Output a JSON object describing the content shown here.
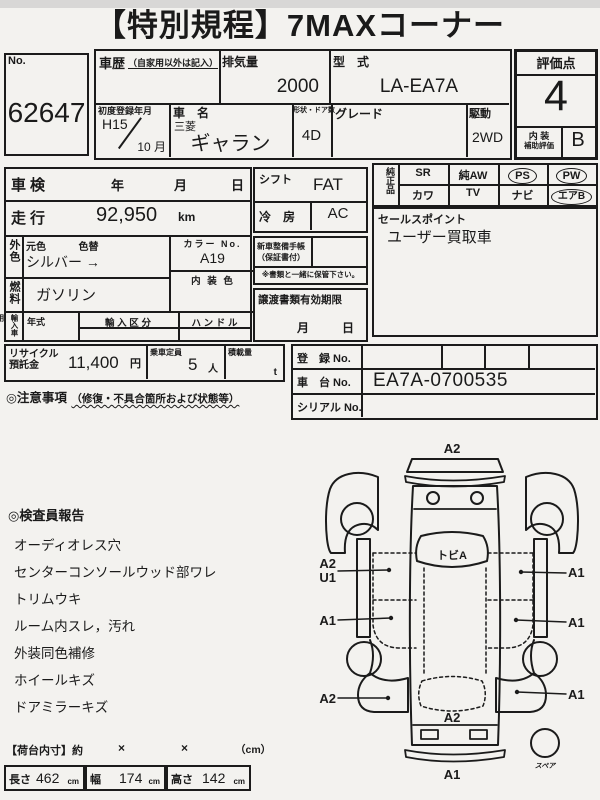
{
  "title": "【特別規程】7MAXコーナー",
  "lot": {
    "label": "No.",
    "value": "62647"
  },
  "header": {
    "history_label": "車歴",
    "history_note": "（自家用以外は記入）",
    "displacement_label": "排気量",
    "displacement_value": "2000",
    "model_code_label": "型　式",
    "model_code_value": "LA-EA7A",
    "first_reg_label": "初度登録年月",
    "first_reg_year": "H15",
    "first_reg_month": "10 月",
    "name_label": "車　名",
    "maker": "三菱",
    "model": "ギャラン",
    "shape_label": "形状・ドア数",
    "shape_value": "4D",
    "grade_label": "グレード",
    "drive_label": "駆動",
    "drive_value": "2WD"
  },
  "rating": {
    "label": "評価点",
    "score": "4",
    "interior_label_1": "内 装",
    "interior_label_2": "補助評価",
    "interior_score": "B"
  },
  "left_panel": {
    "shaken_label": "車検",
    "year": "年",
    "month": "月",
    "day": "日",
    "mileage_label": "走行",
    "mileage_value": "92,950",
    "mileage_unit": "km",
    "ext_color_label": "外色",
    "orig_color_label": "元色",
    "recolor_label": "色替",
    "color_value": "シルバー →",
    "color_no_label": "カラー No.",
    "color_no_value": "A19",
    "fuel_label": "燃料",
    "fuel_value": "ガソリン",
    "interior_color_label": "内 装 色",
    "import_label": "輸入車用",
    "import_year_label": "年式",
    "import_class_label": "輸 入 区 分",
    "handle_label": "ハ ン ド ル",
    "recycle_label_1": "リサイクル",
    "recycle_label_2": "預託金",
    "recycle_value": "11,400",
    "recycle_unit": "円",
    "capacity_label": "乗車定員",
    "capacity_value": "5",
    "capacity_unit": "人",
    "load_label": "積載量",
    "load_unit": "t",
    "notes_label": "◎注意事項",
    "notes_note": "（修復・不具合箇所および状態等）"
  },
  "mid_panel": {
    "shift_label": "シフト",
    "shift_value": "FAT",
    "ac_label": "冷　房",
    "ac_value": "AC",
    "book_label_1": "新車整備手帳",
    "book_label_2": "（保証書付）",
    "keep_note": "※書類と一緒に保管下さい。",
    "transfer_label": "譲渡書類有効期限",
    "transfer_month": "月",
    "transfer_day": "日"
  },
  "options": {
    "label": "純正品",
    "row1": [
      {
        "label": "SR",
        "circled": false
      },
      {
        "label": "純AW",
        "circled": false
      },
      {
        "label": "PS",
        "circled": true
      },
      {
        "label": "PW",
        "circled": true
      }
    ],
    "row2": [
      {
        "label": "カワ",
        "circled": false
      },
      {
        "label": "TV",
        "circled": false
      },
      {
        "label": "ナビ",
        "circled": false
      },
      {
        "label": "エアB",
        "circled": true
      }
    ]
  },
  "sales": {
    "label": "セールスポイント",
    "value": "ユーザー買取車"
  },
  "registration": {
    "reg_label": "登　録 No.",
    "reg_value": "",
    "chassis_label": "車　台 No.",
    "chassis_value": "EA7A-0700535",
    "serial_label": "シリアル No.",
    "serial_value": ""
  },
  "inspector": {
    "label": "◎検査員報告",
    "items": [
      "オーディオレス穴",
      "センターコンソールウッド部ワレ",
      "トリムウキ",
      "ルーム内スレ，汚れ",
      "外装同色補修",
      "ホイールキズ",
      "ドアミラーキズ"
    ]
  },
  "dimensions": {
    "label": "【荷台内寸】約",
    "times1": "×",
    "times2": "×",
    "unit_note": "（cm）",
    "length_label": "長さ",
    "length_value": "462",
    "length_unit": "cm",
    "width_label": "幅",
    "width_value": "174",
    "width_unit": "cm",
    "height_label": "高さ",
    "height_value": "142",
    "height_unit": "cm"
  },
  "diagram": {
    "front": "A2",
    "windshield": "トビA",
    "left_front_a": "A2",
    "left_front_b": "U1",
    "right_front": "A1",
    "left_mid": "A1",
    "right_mid": "A1",
    "left_rear": "A2",
    "right_rear": "A1",
    "rear_glass": "A2",
    "rear": "A1",
    "spare": "スペア"
  }
}
